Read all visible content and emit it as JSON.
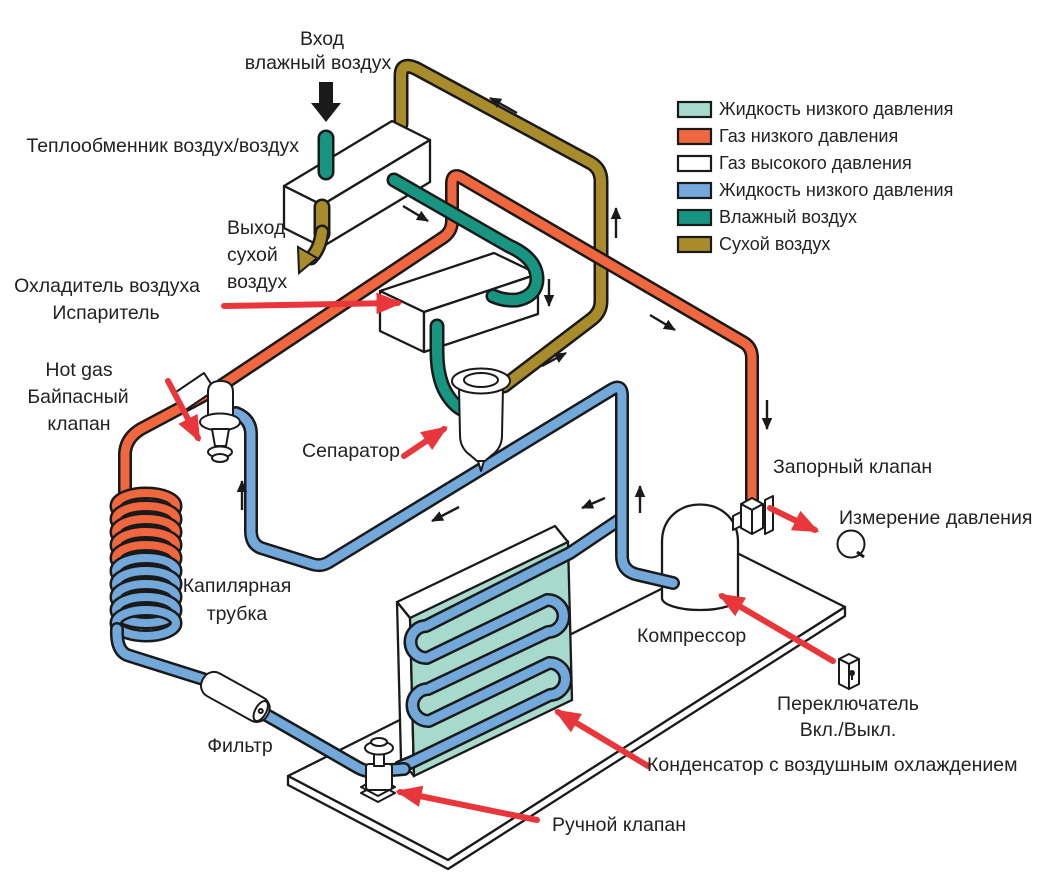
{
  "colors": {
    "liquid_light": "#a7d9cd",
    "gas_low": "#f0663f",
    "gas_high": "#ffffff",
    "liquid_blue": "#73a9da",
    "wet_air": "#179580",
    "dry_air": "#a88b2b",
    "red": "#e8363b",
    "ink": "#1a1a1a"
  },
  "legend": {
    "items": [
      {
        "label": "Жидкость низкого давления",
        "color": "#a7d9cd"
      },
      {
        "label": "Газ низкого давления",
        "color": "#f0663f"
      },
      {
        "label": "Газ высокого давления",
        "color": "#ffffff"
      },
      {
        "label": "Жидкость низкого давления",
        "color": "#73a9da"
      },
      {
        "label": "Влажный воздух",
        "color": "#179580"
      },
      {
        "label": "Сухой воздух",
        "color": "#a88b2b"
      }
    ]
  },
  "labels": {
    "inlet": [
      "Вход",
      "влажный воздух"
    ],
    "heat_exchanger": "Теплообменник воздух/воздух",
    "outlet": [
      "Выход",
      "сухой",
      "воздух"
    ],
    "air_cooler": [
      "Охладитель воздуха",
      "Испаритель"
    ],
    "bypass": [
      "Hot gas",
      "Байпасный",
      "клапан"
    ],
    "separator": "Сепаратор",
    "capillary": [
      "Капилярная",
      "трубка"
    ],
    "filter": "Фильтр",
    "manual_valve": "Ручной клапан",
    "condenser": "Конденсатор с воздушным охлаждением",
    "compressor": "Компрессор",
    "switch": [
      "Переключатель",
      "Вкл./Выкл."
    ],
    "shutoff_valve": "Запорный клапан",
    "pressure": "Измерение давления"
  }
}
